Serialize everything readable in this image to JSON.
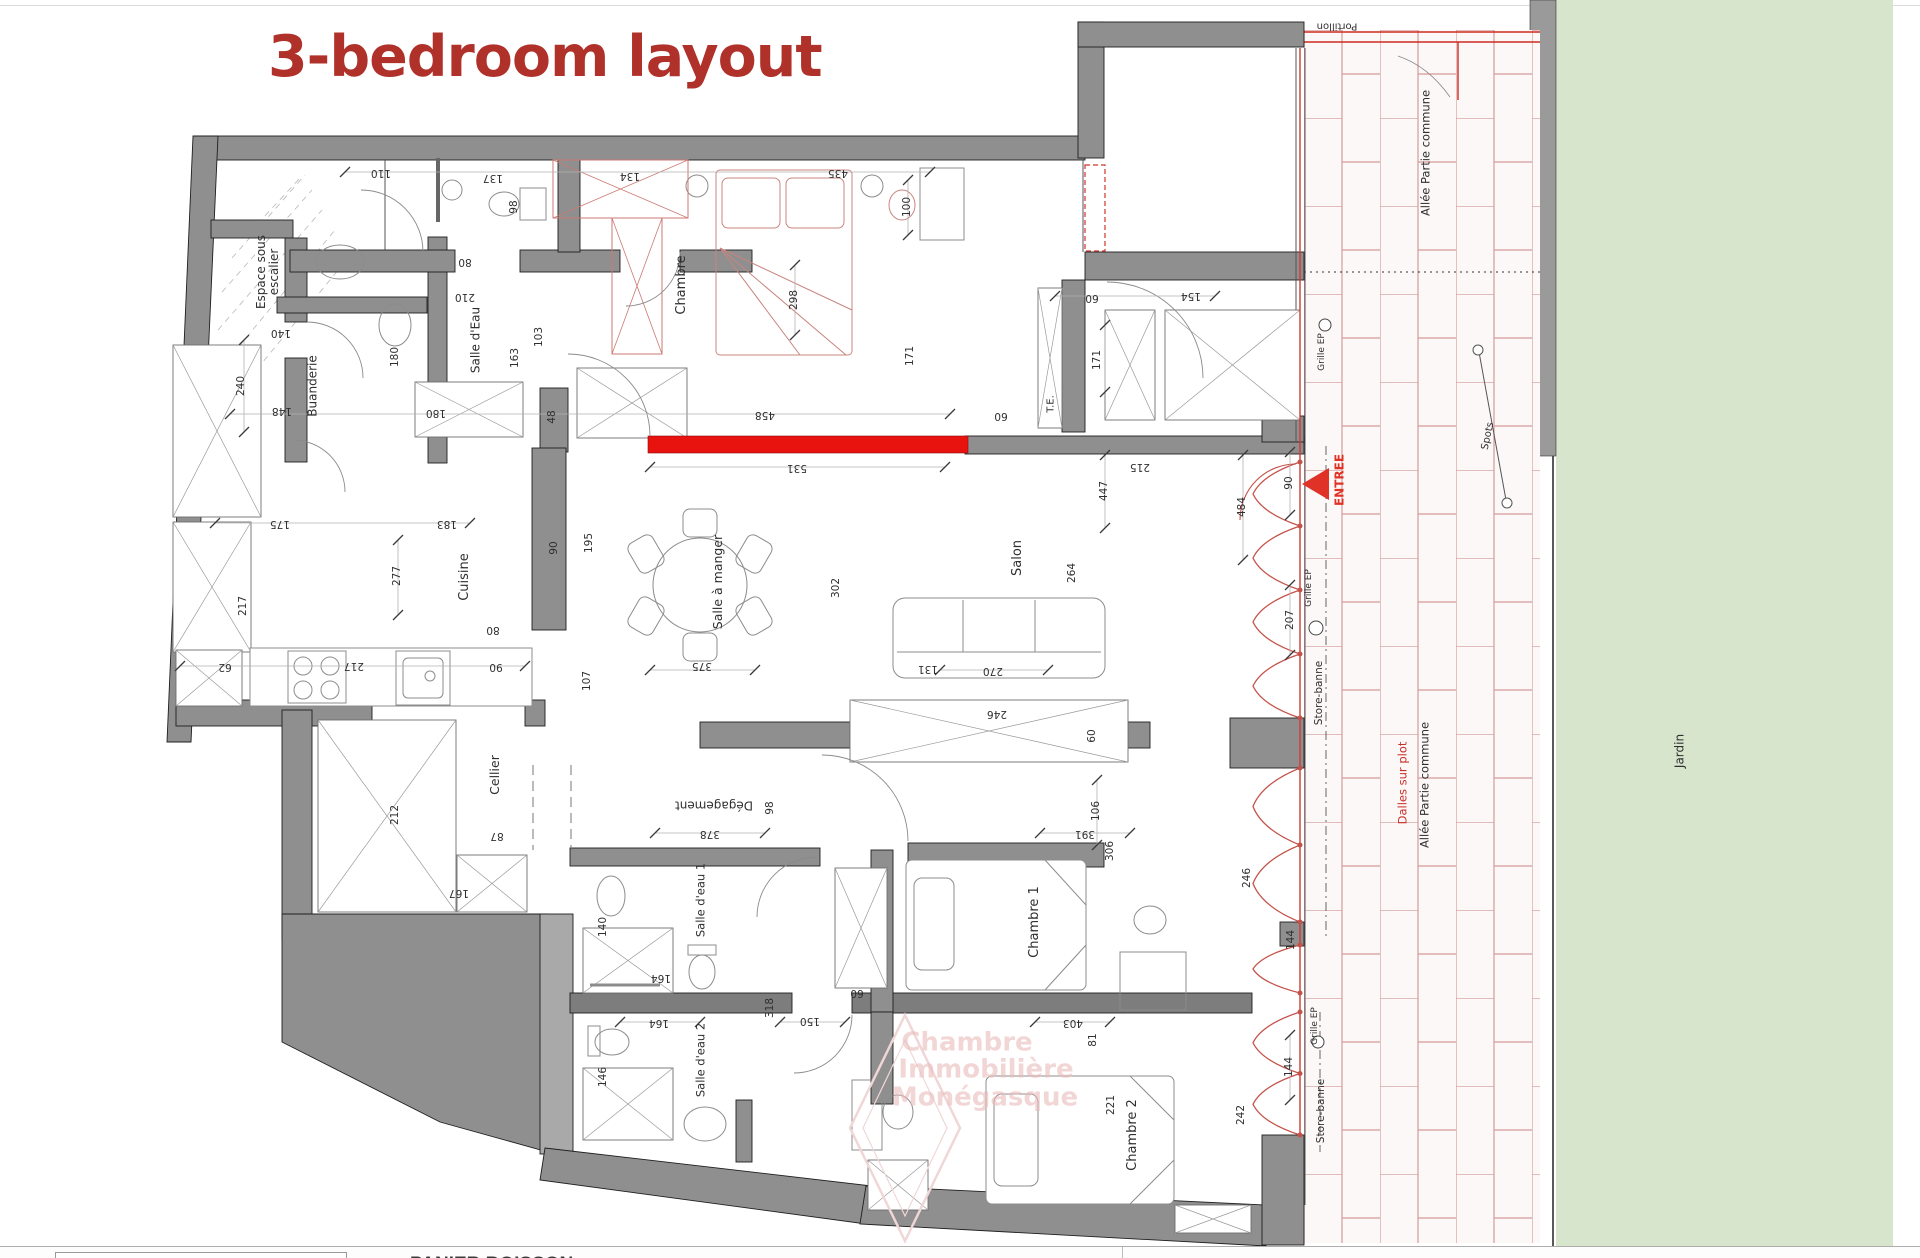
{
  "title": {
    "text": "3-bedroom layout",
    "color": "#b0302a"
  },
  "footer": {
    "partial_text": "PANIER BOISSON"
  },
  "colors": {
    "wall": "#8f8f8f",
    "wall_dark": "#7d7d7d",
    "highlight_red": "#e8120e",
    "facade_red": "#c4524a",
    "tile_joint": "#d49a9a",
    "garden_green": "#d6e5cc",
    "title_red": "#b0302a",
    "watermark_pink": "#eccaca",
    "entree_red": "#e03226"
  },
  "plan": {
    "labels": [
      {
        "t": "Espace sous\nescalier",
        "x": 268,
        "y": 272,
        "r": -90,
        "s": 12,
        "n": "label-espace-sous-escalier"
      },
      {
        "t": "Salle d'Eau",
        "x": 476,
        "y": 340,
        "r": -90,
        "s": 12,
        "n": "label-salle-deau"
      },
      {
        "t": "Buanderie",
        "x": 313,
        "y": 386,
        "r": -90,
        "s": 12,
        "n": "label-buanderie"
      },
      {
        "t": "Chambre",
        "x": 682,
        "y": 285,
        "r": -90,
        "s": 13,
        "n": "label-chambre"
      },
      {
        "t": "Salle à manger",
        "x": 718,
        "y": 582,
        "r": -90,
        "s": 12.5,
        "n": "label-salle-a-manger"
      },
      {
        "t": "Salon",
        "x": 1018,
        "y": 558,
        "r": -90,
        "s": 13,
        "n": "label-salon"
      },
      {
        "t": "Cuisine",
        "x": 465,
        "y": 577,
        "r": -90,
        "s": 13,
        "n": "label-cuisine"
      },
      {
        "t": "Cellier",
        "x": 495,
        "y": 775,
        "r": -90,
        "s": 12.5,
        "n": "label-cellier"
      },
      {
        "t": "Dégagement",
        "x": 714,
        "y": 805,
        "r": 180,
        "s": 12,
        "n": "label-degagement"
      },
      {
        "t": "Salle d'eau 1",
        "x": 701,
        "y": 900,
        "r": -90,
        "s": 11.5,
        "n": "label-salle-deau-1"
      },
      {
        "t": "Salle d'eau 2",
        "x": 701,
        "y": 1060,
        "r": -90,
        "s": 11.5,
        "n": "label-salle-deau-2"
      },
      {
        "t": "Chambre 1",
        "x": 1035,
        "y": 922,
        "r": -90,
        "s": 13,
        "n": "label-chambre-1"
      },
      {
        "t": "Chambre 2",
        "x": 1133,
        "y": 1135,
        "r": -90,
        "s": 13,
        "n": "label-chambre-2"
      },
      {
        "t": "T.E.",
        "x": 1051,
        "y": 404,
        "r": -90,
        "s": 10,
        "n": "label-te"
      },
      {
        "t": "Jardin",
        "x": 1680,
        "y": 751,
        "r": -90,
        "s": 12,
        "n": "label-jardin"
      },
      {
        "t": "Allée Partie commune",
        "x": 1426,
        "y": 153,
        "r": -90,
        "s": 11.5,
        "n": "label-allee-partie-commune-top"
      },
      {
        "t": "Allée Partie commune",
        "x": 1425,
        "y": 785,
        "r": -90,
        "s": 11.5,
        "n": "label-allee-partie-commune-bottom"
      },
      {
        "t": "Dalles sur plot",
        "x": 1403,
        "y": 783,
        "r": -90,
        "s": 11.5,
        "c": "#c9302a",
        "n": "label-dalles-sur-plot"
      },
      {
        "t": "Portillon",
        "x": 1337,
        "y": 26,
        "r": 180,
        "s": 10,
        "n": "label-portillon"
      },
      {
        "t": "Store-banne",
        "x": 1320,
        "y": 693,
        "r": -90,
        "s": 10.5,
        "n": "label-store-banne-top"
      },
      {
        "t": "Store-banne",
        "x": 1322,
        "y": 1111,
        "r": -90,
        "s": 10.5,
        "n": "label-store-banne-bottom"
      },
      {
        "t": "Grille EP",
        "x": 1323,
        "y": 352,
        "r": -90,
        "s": 9,
        "n": "label-grille-ep-1"
      },
      {
        "t": "Grille EP",
        "x": 1310,
        "y": 588,
        "r": -90,
        "s": 9,
        "n": "label-grille-ep-2"
      },
      {
        "t": "Grille EP",
        "x": 1316,
        "y": 1026,
        "r": -90,
        "s": 9,
        "n": "label-grille-ep-3"
      },
      {
        "t": "Spots",
        "x": 1488,
        "y": 436,
        "r": -78,
        "s": 10,
        "n": "label-spots"
      },
      {
        "t": "ENTREE",
        "x": 1340,
        "y": 480,
        "r": -90,
        "s": 12,
        "c": "#e03226",
        "w": 700,
        "n": "label-entree"
      },
      {
        "t": "110",
        "x": 381,
        "y": 172,
        "r": 180
      },
      {
        "t": "137",
        "x": 493,
        "y": 177,
        "r": 180
      },
      {
        "t": "134",
        "x": 630,
        "y": 175,
        "r": 180
      },
      {
        "t": "435",
        "x": 838,
        "y": 172,
        "r": 180
      },
      {
        "t": "80",
        "x": 465,
        "y": 261,
        "r": 180
      },
      {
        "t": "210",
        "x": 465,
        "y": 296,
        "r": 180
      },
      {
        "t": "140",
        "x": 281,
        "y": 332,
        "r": 180
      },
      {
        "t": "148",
        "x": 282,
        "y": 410,
        "r": 180
      },
      {
        "t": "180",
        "x": 436,
        "y": 412,
        "r": 180
      },
      {
        "t": "175",
        "x": 280,
        "y": 523,
        "r": 180
      },
      {
        "t": "183",
        "x": 447,
        "y": 523,
        "r": 180
      },
      {
        "t": "62",
        "x": 225,
        "y": 666,
        "r": 180
      },
      {
        "t": "217",
        "x": 354,
        "y": 665,
        "r": 180
      },
      {
        "t": "80",
        "x": 493,
        "y": 629,
        "r": 180
      },
      {
        "t": "90",
        "x": 496,
        "y": 666,
        "r": 180
      },
      {
        "t": "458",
        "x": 765,
        "y": 414,
        "r": 180
      },
      {
        "t": "531",
        "x": 797,
        "y": 467,
        "r": 180
      },
      {
        "t": "375",
        "x": 702,
        "y": 665,
        "r": 180
      },
      {
        "t": "270",
        "x": 993,
        "y": 670,
        "r": 180
      },
      {
        "t": "246",
        "x": 997,
        "y": 713,
        "r": 180
      },
      {
        "t": "60",
        "x": 1001,
        "y": 415,
        "r": 180
      },
      {
        "t": "215",
        "x": 1140,
        "y": 466,
        "r": 180
      },
      {
        "t": "154",
        "x": 1191,
        "y": 295,
        "r": 180
      },
      {
        "t": "60",
        "x": 1092,
        "y": 297,
        "r": 180
      },
      {
        "t": "87",
        "x": 497,
        "y": 835,
        "r": 180
      },
      {
        "t": "167",
        "x": 459,
        "y": 892,
        "r": 180
      },
      {
        "t": "378",
        "x": 710,
        "y": 833,
        "r": 180
      },
      {
        "t": "391",
        "x": 1085,
        "y": 833,
        "r": 180
      },
      {
        "t": "164",
        "x": 661,
        "y": 977,
        "r": 180
      },
      {
        "t": "164",
        "x": 659,
        "y": 1022,
        "r": 180
      },
      {
        "t": "150",
        "x": 810,
        "y": 1020,
        "r": 180
      },
      {
        "t": "60",
        "x": 857,
        "y": 992,
        "r": 180
      },
      {
        "t": "403",
        "x": 1073,
        "y": 1022,
        "r": 180
      },
      {
        "t": "131",
        "x": 928,
        "y": 668,
        "r": 180
      },
      {
        "t": "98",
        "x": 515,
        "y": 207,
        "r": -90
      },
      {
        "t": "240",
        "x": 242,
        "y": 386,
        "r": -90
      },
      {
        "t": "180",
        "x": 396,
        "y": 357,
        "r": -90
      },
      {
        "t": "163",
        "x": 516,
        "y": 358,
        "r": -90
      },
      {
        "t": "103",
        "x": 540,
        "y": 337,
        "r": -90
      },
      {
        "t": "48",
        "x": 553,
        "y": 417,
        "r": -90
      },
      {
        "t": "90",
        "x": 555,
        "y": 548,
        "r": -90
      },
      {
        "t": "195",
        "x": 590,
        "y": 543,
        "r": -90
      },
      {
        "t": "217",
        "x": 244,
        "y": 606,
        "r": -90
      },
      {
        "t": "277",
        "x": 398,
        "y": 576,
        "r": -90
      },
      {
        "t": "107",
        "x": 588,
        "y": 681,
        "r": -90
      },
      {
        "t": "298",
        "x": 795,
        "y": 300,
        "r": -90
      },
      {
        "t": "100",
        "x": 908,
        "y": 207,
        "r": -90
      },
      {
        "t": "171",
        "x": 911,
        "y": 356,
        "r": -90
      },
      {
        "t": "171",
        "x": 1098,
        "y": 360,
        "r": -90
      },
      {
        "t": "302",
        "x": 837,
        "y": 588,
        "r": -90
      },
      {
        "t": "447",
        "x": 1105,
        "y": 491,
        "r": -90
      },
      {
        "t": "264",
        "x": 1073,
        "y": 573,
        "r": -90
      },
      {
        "t": "484",
        "x": 1243,
        "y": 507,
        "r": -90
      },
      {
        "t": "90",
        "x": 1290,
        "y": 483,
        "r": -90
      },
      {
        "t": "207",
        "x": 1291,
        "y": 620,
        "r": -90
      },
      {
        "t": "212",
        "x": 396,
        "y": 815,
        "r": -90
      },
      {
        "t": "98",
        "x": 771,
        "y": 808,
        "r": -90
      },
      {
        "t": "60",
        "x": 1093,
        "y": 736,
        "r": -90
      },
      {
        "t": "106",
        "x": 1097,
        "y": 811,
        "r": -90
      },
      {
        "t": "306",
        "x": 1111,
        "y": 851,
        "r": -90
      },
      {
        "t": "318",
        "x": 771,
        "y": 1008,
        "r": -90
      },
      {
        "t": "140",
        "x": 604,
        "y": 927,
        "r": -90
      },
      {
        "t": "146",
        "x": 604,
        "y": 1077,
        "r": -90
      },
      {
        "t": "81",
        "x": 1094,
        "y": 1040,
        "r": -90
      },
      {
        "t": "221",
        "x": 1112,
        "y": 1105,
        "r": -90
      },
      {
        "t": "242",
        "x": 1242,
        "y": 1115,
        "r": -90
      },
      {
        "t": "144",
        "x": 1290,
        "y": 1067,
        "r": -90
      },
      {
        "t": "144",
        "x": 1292,
        "y": 940,
        "r": -90
      },
      {
        "t": "246",
        "x": 1248,
        "y": 878,
        "r": -90
      },
      {
        "t": "Chambre",
        "x": 967,
        "y": 1043,
        "r": 0,
        "s": 26,
        "w": 700,
        "c": "rgba(233,186,186,0.6)",
        "n": "watermark-line-1"
      },
      {
        "t": "Immobilière",
        "x": 986,
        "y": 1070,
        "r": 0,
        "s": 26,
        "w": 700,
        "c": "rgba(233,186,186,0.6)",
        "n": "watermark-line-2"
      },
      {
        "t": "Monégasque",
        "x": 985,
        "y": 1098,
        "r": 0,
        "s": 26,
        "w": 700,
        "c": "rgba(233,186,186,0.6)",
        "n": "watermark-line-3"
      }
    ]
  }
}
